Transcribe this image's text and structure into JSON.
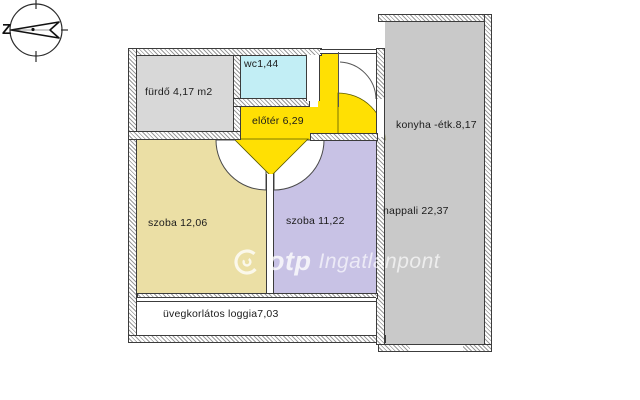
{
  "compass": {
    "label": "Z"
  },
  "watermark": {
    "brand": "otp",
    "suffix": "Ingatlanpont"
  },
  "rooms": [
    {
      "name": "bathroom",
      "label": "fürdő 4,17 m2",
      "color": "#d8d8d8"
    },
    {
      "name": "wc",
      "label": "wc1,44",
      "color": "#c2eef5"
    },
    {
      "name": "hallway",
      "label": "előtér 6,29",
      "color": "#ffe003"
    },
    {
      "name": "kitchen-dining",
      "label": "konyha -étk.8,17",
      "color": "#c9c9c9"
    },
    {
      "name": "living-room",
      "label": "nappali 22,37",
      "color": "#c9c9c9"
    },
    {
      "name": "room-1",
      "label": "szoba 12,06",
      "color": "#ebdfa5"
    },
    {
      "name": "room-2",
      "label": "szoba 11,22",
      "color": "#c8c2e5"
    },
    {
      "name": "loggia",
      "label": "üvegkorlátos loggia7,03",
      "color": "#ffffff"
    }
  ],
  "accent_colors": {
    "hallway_yellow": "#ffe003",
    "wall_outline": "#3c3c3c"
  }
}
